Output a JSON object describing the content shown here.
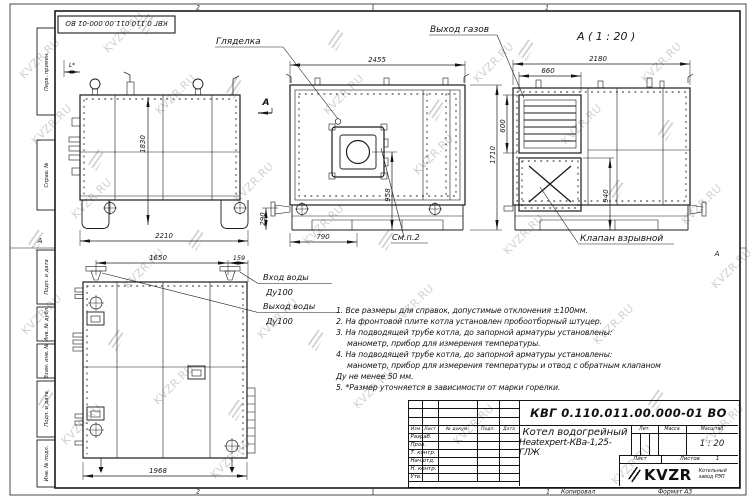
{
  "watermark": {
    "text": "KVZR.RU"
  },
  "frame": {
    "stamp_top": "КВГ 0.110.011.00.000-01 ВО",
    "side_fields": [
      "Перв. примен.",
      "Справ. №",
      "Подп. и дата",
      "Инв. № дубл.",
      "Взам. инв. №",
      "Подп. и дата",
      "Инв. № подл."
    ],
    "zone_top_left": "2",
    "zone_top_right": "1",
    "zone_bottom_left": "2",
    "zone_bottom_right": "1",
    "zone_left": "А",
    "zone_right": "А",
    "copied": "Копировал",
    "format": "Формат А3"
  },
  "labels": {
    "sight_glass": "Гляделка",
    "gas_outlet": "Выход газов",
    "section_view": "А ( 1 : 20 )",
    "section_arrow": "А",
    "explosion_valve": "Клапан взрывной",
    "see_note": "См.п.2",
    "water_in_1": "Вход воды",
    "water_in_2": "Ду100",
    "water_out_1": "Выход воды",
    "water_out_2": "Ду100"
  },
  "dims": {
    "side_offset": "L*",
    "side_height": "1830",
    "side_width": "2210",
    "front_width": "2455",
    "front_burner_x": "790",
    "front_burner_y": "958",
    "front_stub": "290",
    "total_height": "1710",
    "back_width": "2180",
    "back_flue_w": "660",
    "back_flue_h": "600",
    "back_valve": "940",
    "plan_w1": "1650",
    "plan_w2": "159",
    "plan_w3": "1968"
  },
  "notes": {
    "lines": [
      "1. Все размеры для справок, допустимые отклонения ±100мм.",
      "2. На фронтовой плите котла установлен пробоотборный штуцер.",
      "3. На подводящей трубе котла, до запорной арматуры установлены:",
      "манометр, прибор для измерения температуры.",
      "4. На подводящей трубе котла, до запорной арматуры установлены:",
      "манометр, прибор для измерения температуры и отвод с обратным клапаном",
      "Ду не менее 50 мм.",
      "5. *Размер уточняется в зависимости от марки горелки."
    ]
  },
  "titleblock": {
    "designation": "КВГ 0.110.011.00.000-01 ВО",
    "name_line1": "Котел водогрейный",
    "name_line2": "Heatexpert-КВа-1,25-ГЛЖ",
    "col_izm": "Изм",
    "col_list": "Лист",
    "col_doc": "№ докум.",
    "col_sign": "Подп.",
    "col_date": "Дата",
    "rows": [
      "Разраб.",
      "Пров.",
      "Т. контр.",
      "Нач.отд.",
      "Н. контр.",
      "Утв."
    ],
    "lit": "Лит.",
    "mass": "Масса",
    "scale_label": "Масштаб",
    "scale": "1 : 20",
    "sheet_label": "Лист",
    "sheets_label": "Листов",
    "sheets_value": "1",
    "logo": "KVZR",
    "logo_sub1": "Котельный",
    "logo_sub2": "завод РЭП"
  }
}
